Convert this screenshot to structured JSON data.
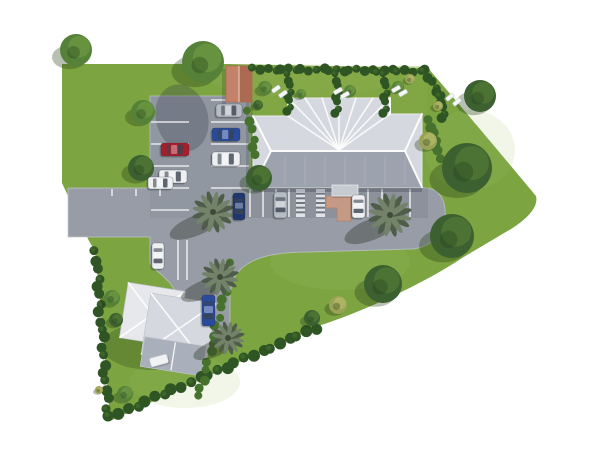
{
  "meta": {
    "title": "Aerial 3D site plan rendering of a property with main building, parking lots, gardens and trees",
    "type": "architectural-3d-site-plan",
    "visible_text": []
  },
  "scene": {
    "width": 600,
    "height": 450,
    "palette": {
      "white": "#ffffff",
      "grass": "#7ca441",
      "grassLight": "#a3c162",
      "garden": "#8dae4a",
      "asphalt": "#979ca6",
      "asphaltDark": "#6f7583",
      "curb": "#c3c7cf",
      "line": "#eff1f3",
      "roofLight": "#e6e8ec",
      "roofMid": "#d5d8de",
      "roofDark": "#9ca2ae",
      "annexDark": "#a9afbb",
      "ridge": "#ffffff",
      "canopy": "#c6cad1",
      "shed": "#c5826a",
      "shedDark": "#ab6a52",
      "walkway": "#c59a85",
      "walkwayDark": "#b2836c",
      "hedge": "#2f5525",
      "hedgeLight": "#47722e",
      "treeDark": "#3c6030",
      "treeMid": "#558238",
      "treeTan": "#9aa355",
      "palm": "#72836a",
      "palmDark": "#4f5c49",
      "carRed": "#a81e2c",
      "carBlue": "#2a4a9c",
      "carNavy": "#20386f",
      "carWhite": "#edeff1",
      "carSilver": "#b7bdc5",
      "glass": "#3a4450"
    },
    "site_outline": "M62,64 L228,64 L428,68 C466,112 536,196 536,196 C539,208 525,220 511,229 L462,258 C431,279 371,309 318,326 L110,421 L103,331 L95,251 L89,241 L62,183 Z",
    "gardens_overlay": {
      "x": 229,
      "y": 66,
      "w": 198,
      "h": 50
    },
    "grass_patches": [
      {
        "cx": 340,
        "cy": 262,
        "rx": 70,
        "ry": 28,
        "o": 0.18
      },
      {
        "cx": 470,
        "cy": 150,
        "rx": 45,
        "ry": 40,
        "o": 0.15
      },
      {
        "cx": 185,
        "cy": 382,
        "rx": 55,
        "ry": 26,
        "o": 0.15
      },
      {
        "cx": 300,
        "cy": 80,
        "rx": 90,
        "ry": 16,
        "o": 0.12
      }
    ],
    "pavement_path": "M68,188 L150,188 L150,96 L250,96 L250,188 L426,188 C442,189 446,204 445,216 C444,236 429,247 413,249 L310,252 C272,252 251,258 239,271 C232,279 230,289 230,299 L230,336 L186,336 C184,303 176,288 165,278 C158,271 151,267 150,262 L150,237 L68,237 Z",
    "lower_band": {
      "x": 232,
      "y": 188,
      "w": 196,
      "h": 30,
      "o": 0.28
    },
    "upper_band": {
      "x": 150,
      "y": 96,
      "w": 100,
      "h": 122,
      "o": 0.12
    },
    "tree_shadow_on_lot": {
      "cx": 182,
      "cy": 118,
      "rx": 26,
      "ry": 34,
      "rot": -15,
      "o": 0.28
    },
    "stalls": {
      "upper_left": {
        "x1": 151,
        "x2": 189,
        "ys": [
          122,
          144,
          166,
          188,
          210
        ]
      },
      "upper_right": {
        "x1": 211,
        "x2": 249,
        "ys": [
          100,
          122,
          144,
          166,
          188
        ]
      },
      "lower": {
        "y1": 189,
        "y2": 217,
        "xs": [
          250,
          263,
          276,
          289,
          368,
          382,
          410
        ]
      },
      "driveway": {
        "y1": 240,
        "y2": 280,
        "xs": [
          178,
          187
        ]
      },
      "ticks": {
        "y1": 189,
        "y2": 196,
        "xs": [
          112,
          136,
          160
        ]
      },
      "hatches": [
        {
          "x": 296,
          "y": 189,
          "w": 9,
          "h": 28
        },
        {
          "x": 316,
          "y": 189,
          "w": 9,
          "h": 28
        }
      ]
    },
    "walkway_path": "M326,196 L351,196 L351,221 L337,221 L337,208 L326,208 Z",
    "main_building": {
      "footprint": "M253,116 L288,116 L288,98 L390,98 L390,114 L422,114 L422,187 L253,187 Z",
      "dark_slope": "M253,187 L422,187 L405,151 L271,151 Z",
      "ridges": [
        [
          271,
          151,
          405,
          151
        ],
        [
          253,
          116,
          271,
          151
        ],
        [
          253,
          187,
          271,
          151
        ],
        [
          422,
          114,
          405,
          151
        ],
        [
          422,
          187,
          405,
          151
        ],
        [
          288,
          98,
          288,
          116
        ],
        [
          390,
          98,
          390,
          114
        ]
      ],
      "fan_center": [
        339,
        150
      ],
      "fan_targets": [
        [
          288,
          98
        ],
        [
          305,
          98
        ],
        [
          322,
          98
        ],
        [
          339,
          98
        ],
        [
          356,
          98
        ],
        [
          373,
          98
        ],
        [
          390,
          98
        ],
        [
          288,
          116
        ],
        [
          390,
          114
        ]
      ],
      "seam_xs": [
        265,
        285,
        305,
        325,
        345,
        365,
        385,
        405
      ],
      "seam_y1": 156,
      "seam_y2": 185,
      "canopy": {
        "x": 332,
        "y": 185,
        "w": 26,
        "h": 11
      },
      "eave_shadow": {
        "x": 253,
        "y": 187,
        "w": 169,
        "h": 5
      },
      "west_shadow": {
        "x": 246,
        "y": 100,
        "w": 7,
        "h": 88
      }
    },
    "annex": {
      "rot": 9,
      "cx": 167,
      "cy": 325,
      "shadow": {
        "cx": 152,
        "cy": 346,
        "rx": 50,
        "ry": 24,
        "o": 0.25
      },
      "parts": [
        {
          "x": 122,
          "y": 289,
          "w": 58,
          "h": 56,
          "fill": "roofLight",
          "pyramid": true
        },
        {
          "x": 146,
          "y": 296,
          "w": 66,
          "h": 62,
          "fill": "roofMid",
          "pyramid": true
        },
        {
          "x": 147,
          "y": 340,
          "w": 62,
          "h": 30,
          "fill": "annexDark",
          "ridgeV": true
        }
      ]
    },
    "shed": {
      "x": 226,
      "y": 66,
      "w": 26,
      "h": 36
    },
    "garden_item": {
      "x": 150,
      "y": 356,
      "w": 18,
      "h": 9,
      "rot": -15
    },
    "hedges": [
      {
        "x1": 254,
        "y1": 69,
        "x2": 426,
        "y2": 71,
        "r": 4,
        "n": 26,
        "c": "hedge"
      },
      {
        "x1": 289,
        "y1": 75,
        "x2": 289,
        "y2": 112,
        "r": 3.5,
        "n": 8,
        "c": "hedge"
      },
      {
        "x1": 337,
        "y1": 75,
        "x2": 337,
        "y2": 114,
        "r": 3.5,
        "n": 8,
        "c": "hedge"
      },
      {
        "x1": 385,
        "y1": 75,
        "x2": 385,
        "y2": 114,
        "r": 3.5,
        "n": 8,
        "c": "hedge"
      },
      {
        "x1": 425,
        "y1": 72,
        "x2": 441,
        "y2": 97,
        "r": 4,
        "n": 6,
        "c": "hedge"
      },
      {
        "x1": 441,
        "y1": 97,
        "x2": 443,
        "y2": 118,
        "r": 4,
        "n": 5,
        "c": "hedge"
      },
      {
        "x1": 430,
        "y1": 121,
        "x2": 439,
        "y2": 158,
        "r": 4.5,
        "n": 7,
        "c": "hedgeLight"
      },
      {
        "x1": 96,
        "y1": 252,
        "x2": 108,
        "y2": 416,
        "r": 4.5,
        "n": 20,
        "c": "hedge"
      },
      {
        "x1": 110,
        "y1": 417,
        "x2": 316,
        "y2": 328,
        "r": 5,
        "n": 24,
        "c": "hedge"
      },
      {
        "x1": 232,
        "y1": 264,
        "x2": 199,
        "y2": 397,
        "r": 4,
        "n": 16,
        "c": "hedgeLight"
      },
      {
        "x1": 249,
        "y1": 112,
        "x2": 255,
        "y2": 156,
        "r": 4,
        "n": 6,
        "c": "hedgeLight"
      }
    ],
    "trees": [
      {
        "cx": 76,
        "cy": 50,
        "r": 16,
        "tone": "mid"
      },
      {
        "cx": 203,
        "cy": 62,
        "r": 21,
        "tone": "mid"
      },
      {
        "cx": 143,
        "cy": 112,
        "r": 12,
        "tone": "mid"
      },
      {
        "cx": 141,
        "cy": 168,
        "r": 13,
        "tone": "dark"
      },
      {
        "cx": 259,
        "cy": 178,
        "r": 13,
        "tone": "dark"
      },
      {
        "cx": 480,
        "cy": 96,
        "r": 16,
        "tone": "dark"
      },
      {
        "cx": 467,
        "cy": 168,
        "r": 25,
        "tone": "dark"
      },
      {
        "cx": 452,
        "cy": 236,
        "r": 22,
        "tone": "dark"
      },
      {
        "cx": 383,
        "cy": 284,
        "r": 19,
        "tone": "dark"
      },
      {
        "cx": 428,
        "cy": 141,
        "r": 9,
        "tone": "tan"
      },
      {
        "cx": 265,
        "cy": 88,
        "r": 7,
        "tone": "mid"
      },
      {
        "cx": 301,
        "cy": 94,
        "r": 5,
        "tone": "mid"
      },
      {
        "cx": 350,
        "cy": 91,
        "r": 6,
        "tone": "mid"
      },
      {
        "cx": 398,
        "cy": 87,
        "r": 6,
        "tone": "mid"
      },
      {
        "cx": 258,
        "cy": 105,
        "r": 5,
        "tone": "dark"
      },
      {
        "cx": 410,
        "cy": 79,
        "r": 5,
        "tone": "tan"
      },
      {
        "cx": 438,
        "cy": 106,
        "r": 5,
        "tone": "tan"
      },
      {
        "cx": 338,
        "cy": 305,
        "r": 9,
        "tone": "tan"
      },
      {
        "cx": 312,
        "cy": 318,
        "r": 8,
        "tone": "dark"
      },
      {
        "cx": 112,
        "cy": 298,
        "r": 8,
        "tone": "mid"
      },
      {
        "cx": 116,
        "cy": 320,
        "r": 7,
        "tone": "dark"
      },
      {
        "cx": 125,
        "cy": 394,
        "r": 8,
        "tone": "mid"
      },
      {
        "cx": 99,
        "cy": 390,
        "r": 4,
        "tone": "tan"
      }
    ],
    "palms": [
      {
        "cx": 213,
        "cy": 212,
        "r": 20
      },
      {
        "cx": 220,
        "cy": 277,
        "r": 18
      },
      {
        "cx": 228,
        "cy": 338,
        "r": 16
      },
      {
        "cx": 390,
        "cy": 215,
        "r": 21
      }
    ],
    "loungers": [
      {
        "x": 276,
        "y": 89,
        "rot": -35
      },
      {
        "x": 283,
        "y": 94,
        "rot": -35
      },
      {
        "x": 338,
        "y": 91,
        "rot": -30
      },
      {
        "x": 345,
        "y": 95,
        "rot": -30
      },
      {
        "x": 396,
        "y": 89,
        "rot": -30
      },
      {
        "x": 403,
        "y": 93,
        "rot": -30
      },
      {
        "x": 450,
        "y": 97,
        "rot": -40
      },
      {
        "x": 457,
        "y": 102,
        "rot": -40
      }
    ],
    "cars": [
      {
        "x": 216,
        "y": 104,
        "w": 26,
        "h": 13,
        "color": "carSilver",
        "dir": "h"
      },
      {
        "x": 212,
        "y": 128,
        "w": 28,
        "h": 13,
        "color": "carBlue",
        "dir": "h"
      },
      {
        "x": 161,
        "y": 143,
        "w": 28,
        "h": 13,
        "color": "carRed",
        "dir": "h"
      },
      {
        "x": 212,
        "y": 152,
        "w": 28,
        "h": 14,
        "color": "carWhite",
        "dir": "h"
      },
      {
        "x": 159,
        "y": 170,
        "w": 28,
        "h": 13,
        "color": "carWhite",
        "dir": "h"
      },
      {
        "x": 148,
        "y": 177,
        "w": 25,
        "h": 12,
        "color": "carWhite",
        "dir": "h"
      },
      {
        "x": 233,
        "y": 193,
        "w": 12,
        "h": 27,
        "color": "carNavy",
        "dir": "v"
      },
      {
        "x": 274,
        "y": 192,
        "w": 13,
        "h": 26,
        "color": "carSilver",
        "dir": "v"
      },
      {
        "x": 352,
        "y": 195,
        "w": 13,
        "h": 23,
        "color": "carWhite",
        "dir": "v"
      },
      {
        "x": 152,
        "y": 243,
        "w": 12,
        "h": 26,
        "color": "carWhite",
        "dir": "v"
      },
      {
        "x": 202,
        "y": 295,
        "w": 13,
        "h": 31,
        "color": "carBlue",
        "dir": "v"
      }
    ]
  }
}
